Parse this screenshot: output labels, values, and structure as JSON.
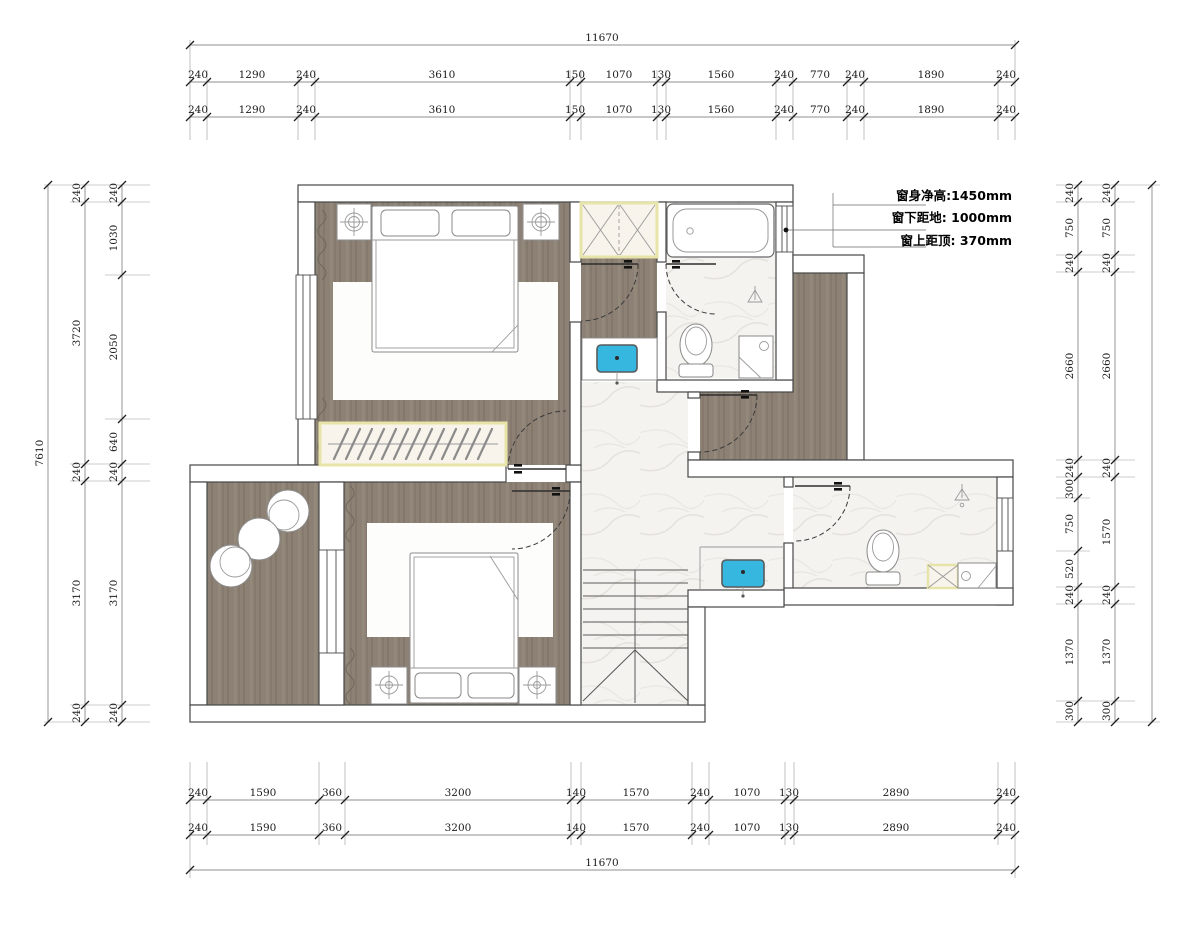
{
  "annotation": {
    "lines": [
      "窗身净高:1450mm",
      "窗下距地: 1000mm",
      "窗上距顶: 370mm"
    ]
  },
  "dimensions": {
    "top": {
      "total": "11670",
      "row1": [
        "240",
        "1290",
        "240",
        "3610",
        "150",
        "1070",
        "130",
        "1560",
        "240",
        "770",
        "240",
        "1890",
        "240"
      ],
      "row2": [
        "240",
        "1290",
        "240",
        "3610",
        "150",
        "1070",
        "130",
        "1560",
        "240",
        "770",
        "240",
        "1890",
        "240"
      ]
    },
    "bottom": {
      "row1": [
        "240",
        "1590",
        "360",
        "3200",
        "140",
        "1570",
        "240",
        "1070",
        "130",
        "2890",
        "240"
      ],
      "row2": [
        "240",
        "1590",
        "360",
        "3200",
        "140",
        "1570",
        "240",
        "1070",
        "130",
        "2890",
        "240"
      ],
      "total": "11670"
    },
    "left": {
      "total": "7610",
      "outer": [
        "240",
        "3720",
        "240",
        "3170",
        "240"
      ],
      "inner": [
        "240",
        "1030",
        "2050",
        "640",
        "240",
        "3170",
        "240"
      ]
    },
    "right": {
      "total": "7610",
      "inner": [
        "240",
        "750",
        "240",
        "2660",
        "240",
        "300",
        "750",
        "520",
        "240",
        "1370",
        "300"
      ],
      "outer": [
        "240",
        "750",
        "240",
        "2660",
        "240",
        "1570",
        "240",
        "1370",
        "300"
      ]
    }
  },
  "colors": {
    "wood": "#8c8174",
    "marble": "#f4f3f0",
    "sink_blue": "#35b7e0",
    "cabinet_fill": "#f8f4ec",
    "cabinet_border": "#e7e4a9",
    "wall_line": "#474747"
  }
}
